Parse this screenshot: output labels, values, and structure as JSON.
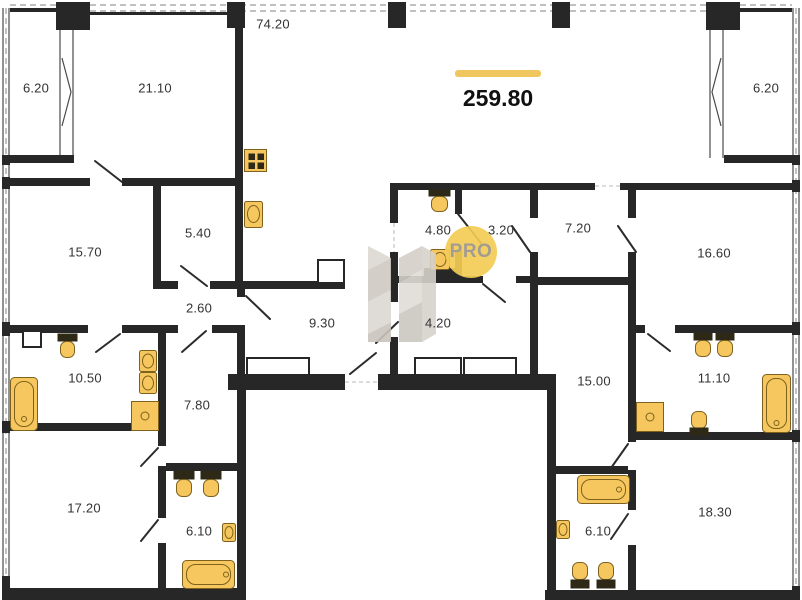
{
  "plan": {
    "total_area": "259.80",
    "watermark": {
      "text": "PRO"
    },
    "colors": {
      "wall": "#272727",
      "fixture": "#F5C75E",
      "fixture_border": "#7D611C",
      "accent_bar": "#EFC75E",
      "watermark_circle": "#F3CB54",
      "watermark_text": "#A29C93",
      "facade_dash": "#9A9A9A"
    },
    "rooms": [
      {
        "id": "balcony-left",
        "area": "6.20"
      },
      {
        "id": "bedroom-top-left",
        "area": "21.10"
      },
      {
        "id": "terrace",
        "area": "74.20"
      },
      {
        "id": "balcony-right",
        "area": "6.20"
      },
      {
        "id": "room-15-70",
        "area": "15.70"
      },
      {
        "id": "closet-5-40",
        "area": "5.40"
      },
      {
        "id": "hall-2-60",
        "area": "2.60"
      },
      {
        "id": "corridor-9-30",
        "area": "9.30"
      },
      {
        "id": "wc-4-80",
        "area": "4.80"
      },
      {
        "id": "room-3-20",
        "area": "3.20"
      },
      {
        "id": "hall-4-20",
        "area": "4.20"
      },
      {
        "id": "hall-7-20",
        "area": "7.20"
      },
      {
        "id": "bedroom-16-60",
        "area": "16.60"
      },
      {
        "id": "bathroom-10-50",
        "area": "10.50"
      },
      {
        "id": "hall-7-80",
        "area": "7.80"
      },
      {
        "id": "hall-15-00",
        "area": "15.00"
      },
      {
        "id": "bathroom-11-10",
        "area": "11.10"
      },
      {
        "id": "bedroom-17-20",
        "area": "17.20"
      },
      {
        "id": "bathroom-6-10-left",
        "area": "6.10"
      },
      {
        "id": "bathroom-6-10-right",
        "area": "6.10"
      },
      {
        "id": "bedroom-18-30",
        "area": "18.30"
      }
    ]
  }
}
